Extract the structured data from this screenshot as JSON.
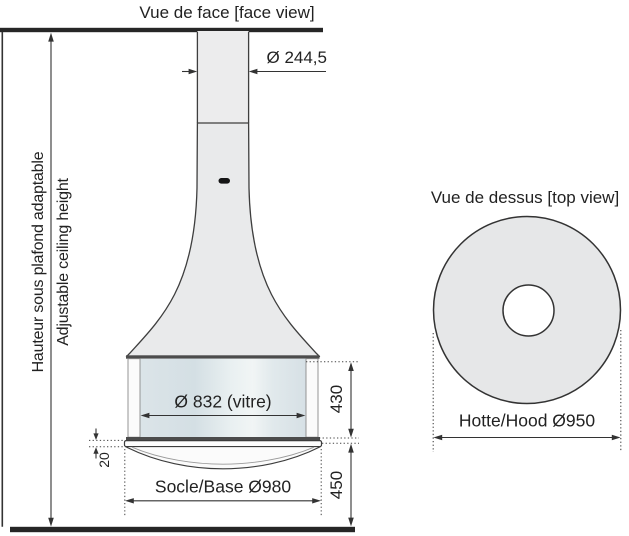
{
  "drawing": {
    "face_view": {
      "title": "Vue de face [face view]",
      "flue_diameter_label": "Ø 244,5",
      "glass_diameter_label": "Ø 832 (vitre)",
      "glass_height_label": "430",
      "base_to_floor_label": "450",
      "base_thickness_label": "20",
      "base_diameter_label": "Socle/Base Ø980",
      "ceiling_height_label_fr": "Hauteur sous plafond adaptable",
      "ceiling_height_label_en": "Adjustable ceiling height"
    },
    "top_view": {
      "title": "Vue de dessus [top view]",
      "hood_diameter_label": "Hotte/Hood Ø950"
    },
    "colors": {
      "line": "#333333",
      "heavy_line": "#262626",
      "body_fill": "#e9eaeb",
      "glass_fill": "#dce5e9",
      "text": "#222222"
    }
  }
}
